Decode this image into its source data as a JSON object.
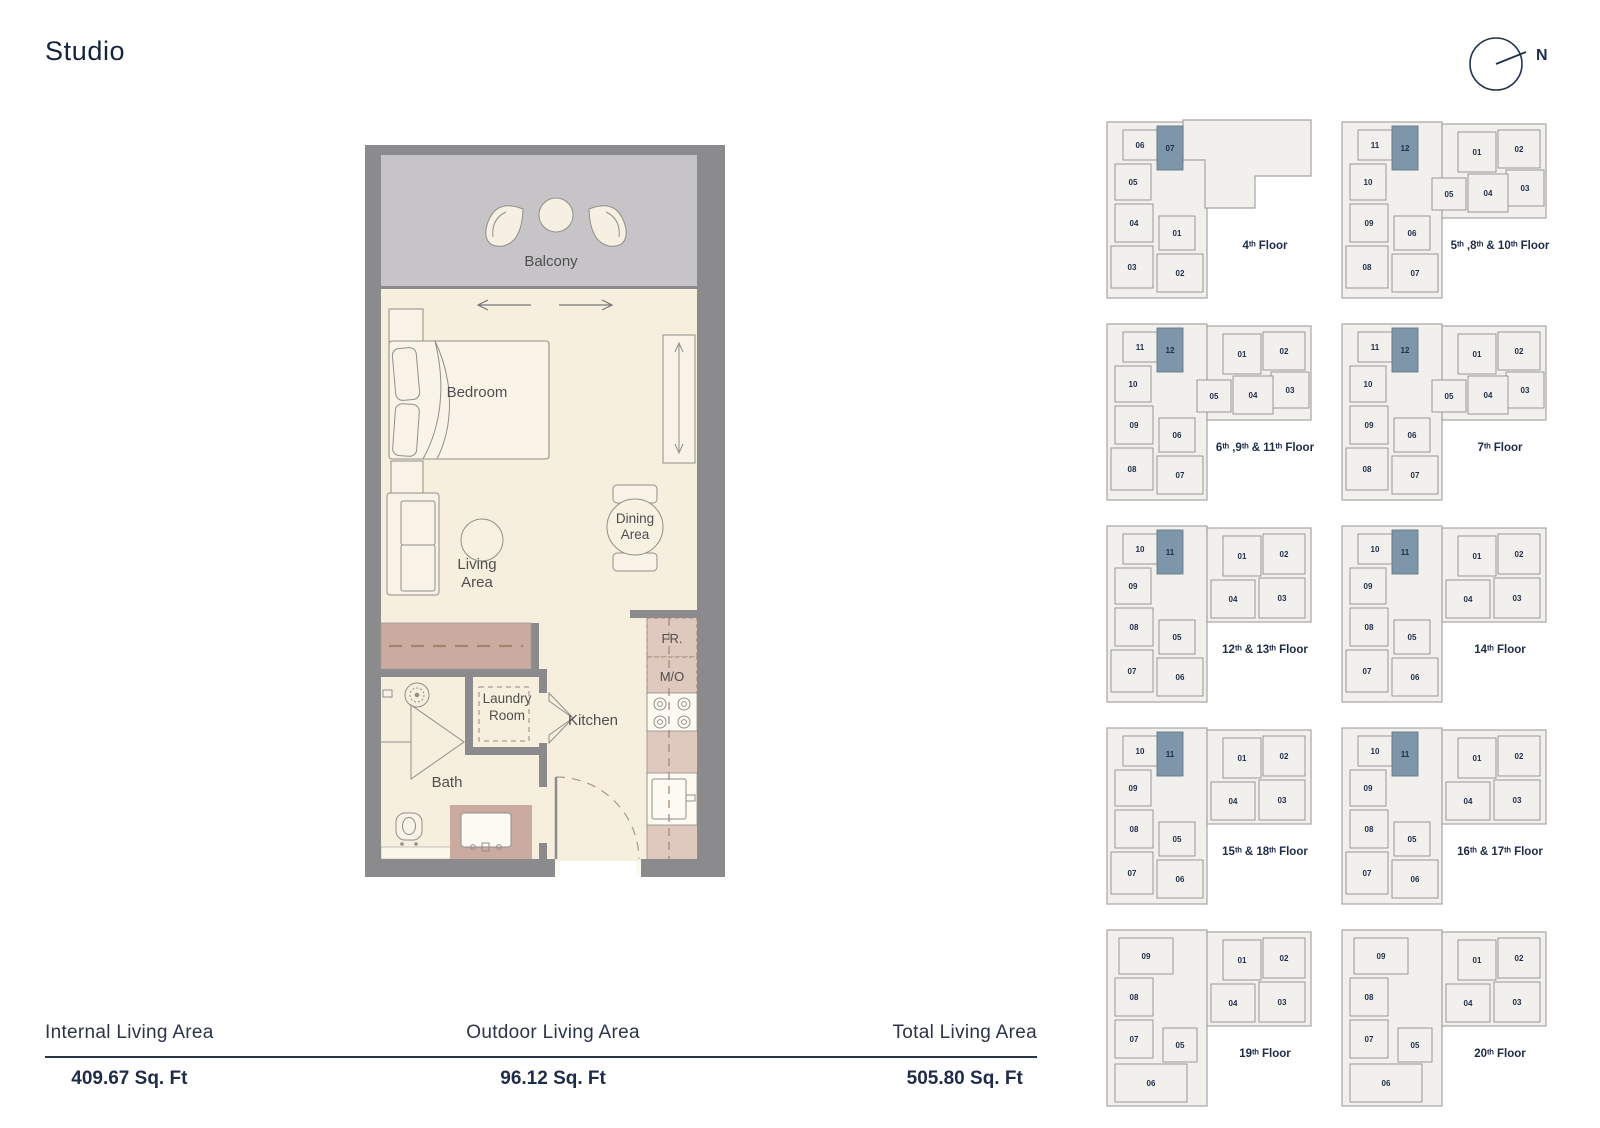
{
  "title": "Studio",
  "compass": {
    "label": "N"
  },
  "floor_plan": {
    "rooms": {
      "balcony": "Balcony",
      "bedroom": "Bedroom",
      "living1": "Living",
      "living2": "Area",
      "dining1": "Dining",
      "dining2": "Area",
      "laundry1": "Laundry",
      "laundry2": "Room",
      "kitchen": "Kitchen",
      "bath": "Bath",
      "fr": "FR.",
      "mo": "M/O"
    }
  },
  "key_plans": [
    {
      "label": "4ᵗʰ Floor",
      "type": "A",
      "highlighted": "07",
      "units": [
        "06",
        "07",
        "05",
        "04",
        "03",
        "01",
        "02"
      ]
    },
    {
      "label": "5ᵗʰ ,8ᵗʰ & 10ᵗʰ Floor",
      "type": "B",
      "highlighted": "12",
      "units": [
        "11",
        "12",
        "10",
        "09",
        "08",
        "06",
        "07",
        "01",
        "02",
        "03",
        "05",
        "04"
      ]
    },
    {
      "label": "6ᵗʰ ,9ᵗʰ & 11ᵗʰ Floor",
      "type": "B",
      "highlighted": "12",
      "units": [
        "11",
        "12",
        "10",
        "09",
        "08",
        "06",
        "07",
        "01",
        "02",
        "03",
        "05",
        "04"
      ]
    },
    {
      "label": "7ᵗʰ Floor",
      "type": "B",
      "highlighted": "12",
      "units": [
        "11",
        "12",
        "10",
        "09",
        "08",
        "06",
        "07",
        "01",
        "02",
        "03",
        "05",
        "04"
      ]
    },
    {
      "label": "12ᵗʰ & 13ᵗʰ Floor",
      "type": "C",
      "highlighted": "11",
      "units": [
        "10",
        "11",
        "09",
        "08",
        "07",
        "05",
        "06",
        "01",
        "02",
        "04",
        "03"
      ]
    },
    {
      "label": "14ᵗʰ Floor",
      "type": "C",
      "highlighted": "11",
      "units": [
        "10",
        "11",
        "09",
        "08",
        "07",
        "05",
        "06",
        "01",
        "02",
        "04",
        "03"
      ]
    },
    {
      "label": "15ᵗʰ & 18ᵗʰ Floor",
      "type": "C",
      "highlighted": "11",
      "units": [
        "10",
        "11",
        "09",
        "08",
        "07",
        "05",
        "06",
        "01",
        "02",
        "04",
        "03"
      ]
    },
    {
      "label": "16ᵗʰ & 17ᵗʰ Floor",
      "type": "C",
      "highlighted": "11",
      "units": [
        "10",
        "11",
        "09",
        "08",
        "07",
        "05",
        "06",
        "01",
        "02",
        "04",
        "03"
      ]
    },
    {
      "label": "19ᵗʰ Floor",
      "type": "D",
      "highlighted": null,
      "units": [
        "09",
        "08",
        "07",
        "05",
        "06",
        "01",
        "02",
        "04",
        "03"
      ]
    },
    {
      "label": "20ᵗʰ Floor",
      "type": "D",
      "highlighted": null,
      "units": [
        "09",
        "08",
        "07",
        "05",
        "06",
        "01",
        "02",
        "04",
        "03"
      ]
    }
  ],
  "stats": [
    {
      "label": "Internal Living Area",
      "value": "409.67 Sq. Ft"
    },
    {
      "label": "Outdoor Living Area",
      "value": "96.12 Sq. Ft"
    },
    {
      "label": "Total Living Area",
      "value": "505.80 Sq. Ft"
    }
  ],
  "colors": {
    "navy": "#1f2c49",
    "wall_gray": "#8b8b8d",
    "floor_cream": "#f7efde",
    "balcony_gray": "#c7c4c8",
    "wardrobe_mauve": "#cbab9f",
    "counter_pink": "#dfc8bd",
    "keyplan_fill": "#f1f0ec",
    "highlight": "#7e96a9"
  }
}
